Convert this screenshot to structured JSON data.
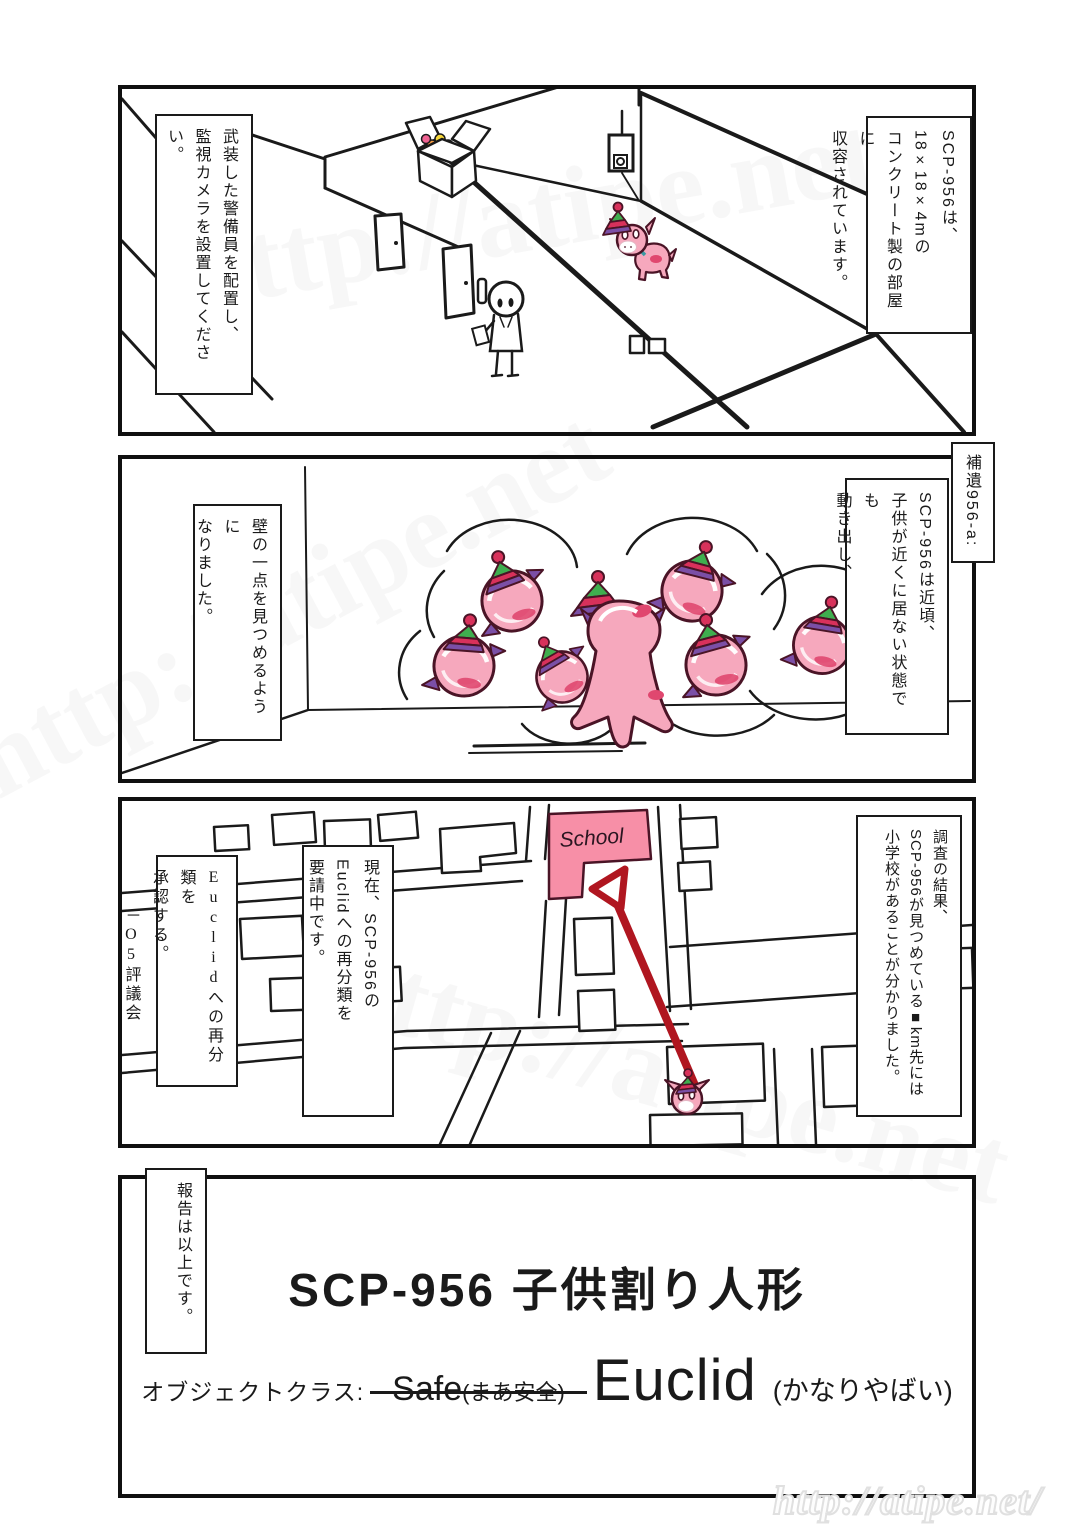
{
  "page": {
    "watermark_url": "http://atipe.net/"
  },
  "panels": {
    "panel1": {
      "caption_right": "SCP-956は、\n18×18×4mの\nコンクリート製の部屋に\n収容されています。",
      "caption_left": "武装した警備員を配置し、\n監視カメラを設置してください。"
    },
    "panel2": {
      "addendum_label": "補遺956-a:",
      "caption_right": "SCP-956は近頃、\n子供が近くに居ない状態でも\n動き出し、",
      "caption_left": "壁の一点を見つめるように\nなりました。"
    },
    "panel3": {
      "caption_right": "調査の結果、\nSCP-956が見つめている■km先には\n小学校があることが分かりました。",
      "caption_request": "現在、SCP-956の\nEuclidへの再分類を\n要請中です。",
      "caption_approval": "Euclidへの再分類を\n承認する。\n　　－O5評議会",
      "school_label": "School"
    },
    "panel4": {
      "caption_left": "報告は以上です。",
      "title": "SCP-956 子供割り人形",
      "object_class_label": "オブジェクトクラス:",
      "old_class": "Safe",
      "old_class_note": "(まあ安全)",
      "new_class": "Euclid",
      "new_class_note": "(かなりやばい)"
    }
  },
  "colors": {
    "ink": "#1a1a1a",
    "pinata_pink": "#f6a8bd",
    "pinata_outline": "#4a1426",
    "hat_green": "#3fae4f",
    "hat_red": "#d8315b",
    "hat_purple": "#7b4fa6",
    "patch_red": "#e0476f",
    "school_pink": "#f78fa7",
    "arrow_red": "#b01620",
    "watermark_gray": "#e0e0e0"
  }
}
